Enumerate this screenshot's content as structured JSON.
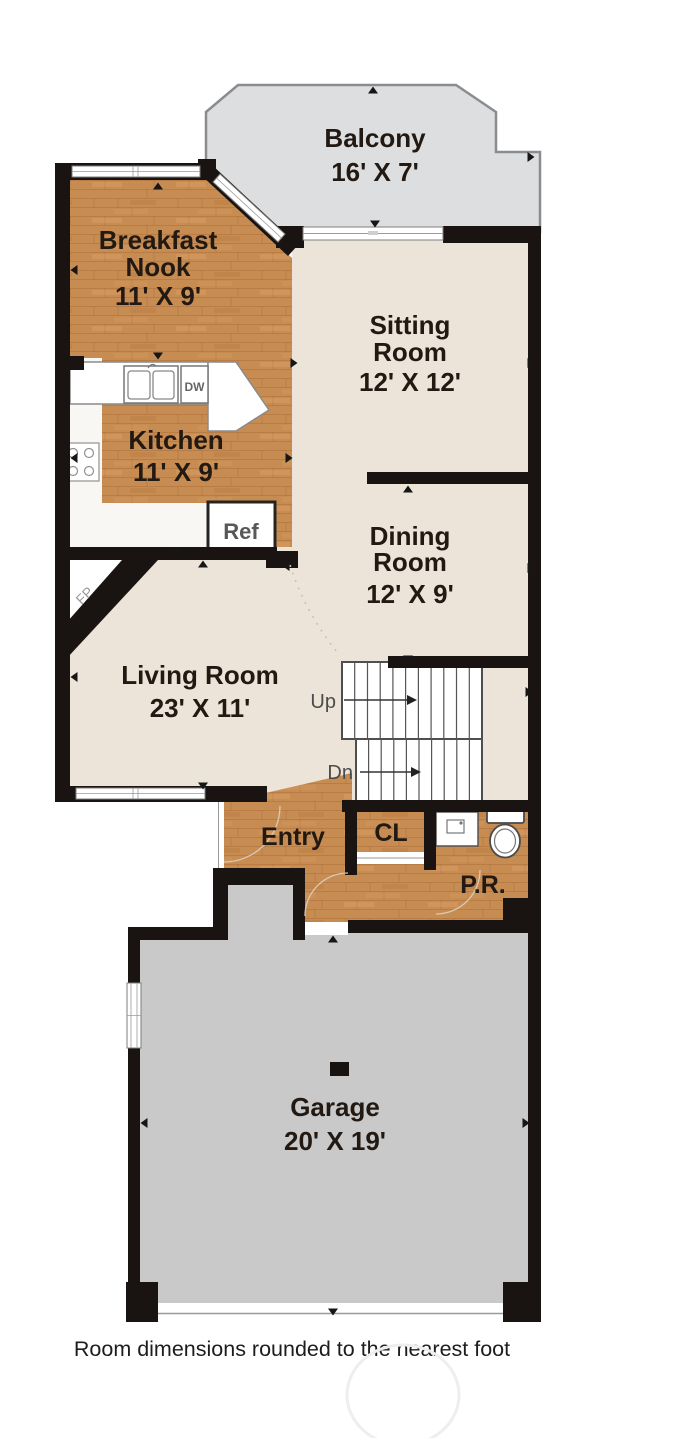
{
  "plan": {
    "rooms": {
      "balcony": {
        "name": "Balcony",
        "dims": "16' X 7'"
      },
      "breakfast_nook": {
        "line1": "Breakfast",
        "line2": "Nook",
        "dims": "11' X 9'"
      },
      "sitting_room": {
        "line1": "Sitting",
        "line2": "Room",
        "dims": "12' X 12'"
      },
      "kitchen": {
        "name": "Kitchen",
        "dims": "11' X 9'"
      },
      "dining_room": {
        "line1": "Dining",
        "line2": "Room",
        "dims": "12' X 9'"
      },
      "living_room": {
        "name": "Living Room",
        "dims": "23' X 11'"
      },
      "entry": {
        "name": "Entry"
      },
      "closet": {
        "name": "CL"
      },
      "powder_room": {
        "name": "P.R."
      },
      "garage": {
        "name": "Garage",
        "dims": "20' X 19'"
      }
    },
    "stairs": {
      "up": "Up",
      "down": "Dn"
    },
    "fixtures": {
      "refrigerator": "Ref",
      "dishwasher": "DW",
      "fireplace": "FP"
    },
    "note": "Room dimensions rounded to the nearest foot",
    "colors": {
      "wall": "#191411",
      "floor_beige": "#ece4d8",
      "wood": "#c78c52",
      "balcony_gray": "#dcdee0",
      "garage_gray": "#c9c9ca",
      "kitchen_white": "#f9f7f4"
    }
  }
}
